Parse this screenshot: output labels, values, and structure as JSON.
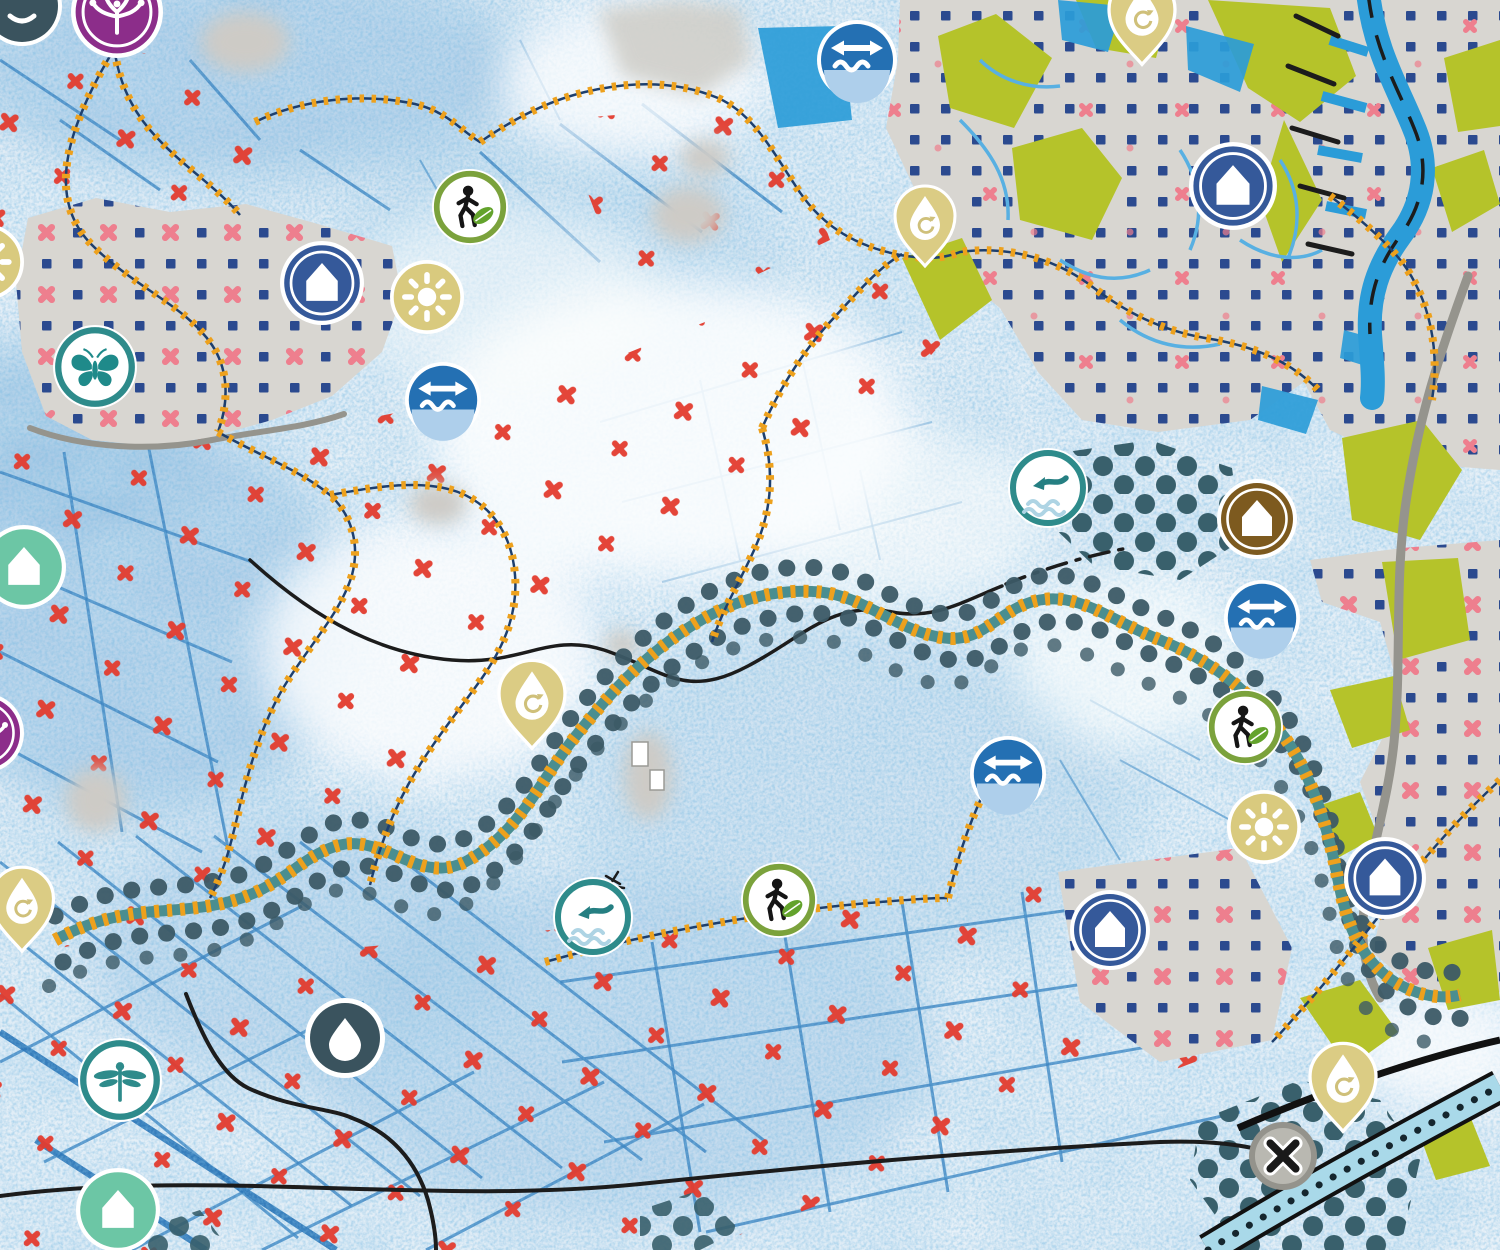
{
  "map": {
    "palette": {
      "polder_base": "#e8f1f8",
      "polder_wash": "#aecde8",
      "field_line_blue": "#3e86c2",
      "urban_grey": "#d8d6d1",
      "urban_square_navy": "#2b4a8f",
      "urban_cross_pink": "#ee7f8e",
      "green_space_olive": "#b5c32a",
      "red_cross_marker": "#e23b2e",
      "route_orange": "#eda11d",
      "route_navy": "#1d3f6e",
      "corridor_teal": "#4a8e90",
      "corridor_dot": "#3c5a66",
      "canal_blue": "#2b9cd8",
      "canal_light": "#a9d9e9",
      "road_black": "#1c1c1c",
      "road_grey": "#95948d"
    },
    "layers": [
      {
        "name": "polder-texture",
        "color": "#e8f1f8"
      },
      {
        "name": "field-ditch-network",
        "color": "#3e86c2"
      },
      {
        "name": "red-cross-overlay",
        "color": "#e23b2e"
      },
      {
        "name": "urban-areas-dot-grid",
        "color": "#d8d6d1"
      },
      {
        "name": "green-spaces",
        "color": "#b5c32a"
      },
      {
        "name": "wetland-dot-fields",
        "color": "#39606c"
      },
      {
        "name": "canals",
        "color": "#2b9cd8"
      },
      {
        "name": "roads-dikes",
        "color": "#1c1c1c"
      },
      {
        "name": "river-corridor",
        "color": "#4a8e90"
      },
      {
        "name": "orange-dashed-routes",
        "color": "#eda11d"
      }
    ],
    "marker_styles": {
      "house-blue": {
        "bg": "#35599a",
        "glyph": "#ffffff"
      },
      "house-brown": {
        "bg": "#7d5a1f",
        "glyph": "#ffffff"
      },
      "house-mint": {
        "bg": "#6cc6a5",
        "glyph": "#ffffff"
      },
      "boat-blue": {
        "bg": "#2470b3",
        "half": "#aecfeb",
        "glyph": "#ffffff"
      },
      "boat-teal": {
        "bg": "#ffffff",
        "ring": "#2e8b8b",
        "glyph": "#257f82",
        "wave": "#aed4e4"
      },
      "sun-khaki": {
        "bg": "#d9ca7e",
        "glyph": "#ffffff"
      },
      "walk-leaf": {
        "bg": "#ffffff",
        "ring": "#7ba23c",
        "glyph": "#151515",
        "leaf": "#63a32c"
      },
      "butterfly": {
        "bg": "#ffffff",
        "ring": "#2e8b8b",
        "glyph": "#1f8a8a"
      },
      "dragonfly": {
        "bg": "#ffffff",
        "ring": "#2e8b8b",
        "glyph": "#2e8b8b"
      },
      "drop-dark": {
        "bg": "#3a535e",
        "glyph": "#ffffff"
      },
      "flower-purple": {
        "bg": "#8c2d8a",
        "glyph": "#ffffff"
      },
      "pin-water-khaki": {
        "bg": "#dbcc84",
        "glyph": "#ffffff",
        "arrows": "#cfc07a"
      },
      "x-barrier": {
        "bg": "#94938c",
        "inner": "#b9b8b1",
        "glyph": "#1a1a1a"
      },
      "circle-dark-partial": {
        "bg": "#3a535e",
        "glyph": "#ffffff"
      }
    },
    "markers": [
      {
        "type": "circle-dark-partial",
        "x": 22,
        "y": 6,
        "r": 40
      },
      {
        "type": "flower-purple",
        "x": 117,
        "y": 12,
        "r": 46
      },
      {
        "type": "boat-blue",
        "x": 857,
        "y": 60,
        "r": 40
      },
      {
        "type": "pin-water-khaki",
        "x": 1142,
        "y": 16,
        "r": 44
      },
      {
        "type": "house-blue",
        "x": 1233,
        "y": 186,
        "r": 44
      },
      {
        "type": "walk-leaf",
        "x": 470,
        "y": 207,
        "r": 38
      },
      {
        "type": "pin-water-khaki",
        "x": 925,
        "y": 222,
        "r": 40
      },
      {
        "type": "house-blue",
        "x": 322,
        "y": 283,
        "r": 42
      },
      {
        "type": "sun-khaki",
        "x": 427,
        "y": 297,
        "r": 37
      },
      {
        "type": "sun-khaki",
        "x": -14,
        "y": 262,
        "r": 38
      },
      {
        "type": "butterfly",
        "x": 95,
        "y": 367,
        "r": 42
      },
      {
        "type": "boat-blue",
        "x": 443,
        "y": 400,
        "r": 38
      },
      {
        "type": "boat-teal",
        "x": 1048,
        "y": 488,
        "r": 40
      },
      {
        "type": "house-brown",
        "x": 1257,
        "y": 519,
        "r": 40
      },
      {
        "type": "house-mint",
        "x": 24,
        "y": 567,
        "r": 42
      },
      {
        "type": "boat-blue",
        "x": 1262,
        "y": 618,
        "r": 38
      },
      {
        "type": "pin-water-khaki",
        "x": 532,
        "y": 700,
        "r": 44
      },
      {
        "type": "flower-purple",
        "x": -16,
        "y": 733,
        "r": 40
      },
      {
        "type": "walk-leaf",
        "x": 1245,
        "y": 727,
        "r": 38
      },
      {
        "type": "boat-blue",
        "x": 1008,
        "y": 774,
        "r": 38
      },
      {
        "type": "sun-khaki",
        "x": 1264,
        "y": 827,
        "r": 37
      },
      {
        "type": "house-blue",
        "x": 1385,
        "y": 878,
        "r": 41
      },
      {
        "type": "pin-water-khaki",
        "x": 22,
        "y": 905,
        "r": 42
      },
      {
        "type": "walk-leaf",
        "x": 779,
        "y": 900,
        "r": 38
      },
      {
        "type": "boat-teal",
        "x": 593,
        "y": 917,
        "r": 40
      },
      {
        "type": "house-blue",
        "x": 1110,
        "y": 930,
        "r": 40
      },
      {
        "type": "drop-dark",
        "x": 345,
        "y": 1038,
        "r": 40
      },
      {
        "type": "dragonfly",
        "x": 120,
        "y": 1080,
        "r": 42
      },
      {
        "type": "pin-water-khaki",
        "x": 1343,
        "y": 1083,
        "r": 44
      },
      {
        "type": "x-barrier",
        "x": 1283,
        "y": 1156,
        "r": 34
      },
      {
        "type": "house-mint",
        "x": 118,
        "y": 1210,
        "r": 42
      }
    ]
  }
}
